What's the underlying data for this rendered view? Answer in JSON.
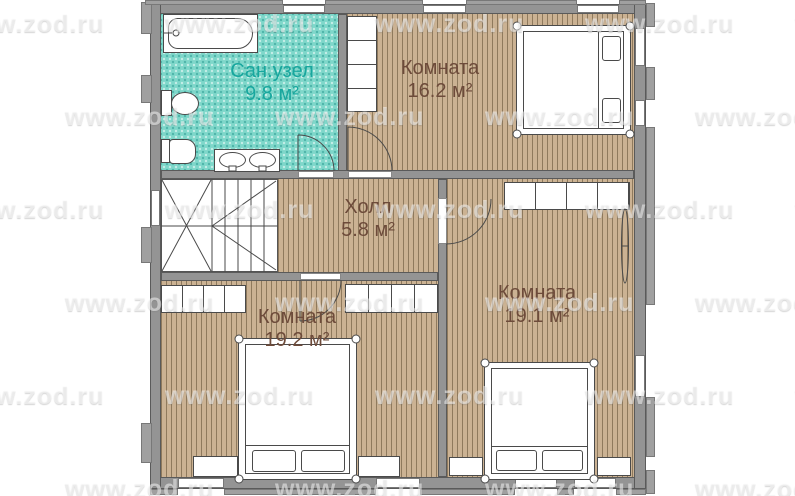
{
  "watermark": {
    "text": "www.zod.ru"
  },
  "plan": {
    "rooms": [
      {
        "name": "Сан.узел",
        "area": "9.8 м²"
      },
      {
        "name": "Комната",
        "area": "16.2 м²"
      },
      {
        "name": "Холл",
        "area": "5.8 м²"
      },
      {
        "name": "Комната",
        "area": "19.2 м²"
      },
      {
        "name": "Комната",
        "area": "19.1 м²"
      }
    ],
    "fixtures": {
      "bathroom": [
        "bathtub",
        "toilet",
        "bidet",
        "double-sink"
      ],
      "bedrooms": [
        "double-bed",
        "wardrobe",
        "nightstand"
      ],
      "other": [
        "staircase",
        "radiator",
        "door",
        "window"
      ]
    }
  },
  "colors": {
    "floor-wood": "#cbb293",
    "floor-wood-stripe": "#8f7a5d",
    "floor-bath": "#7fd7ca",
    "wall": "#949494",
    "wall-edge": "#5a5a5a",
    "label-brown": "#6d4b3a",
    "label-teal": "#18a79e",
    "line": "#4a4a4a"
  }
}
